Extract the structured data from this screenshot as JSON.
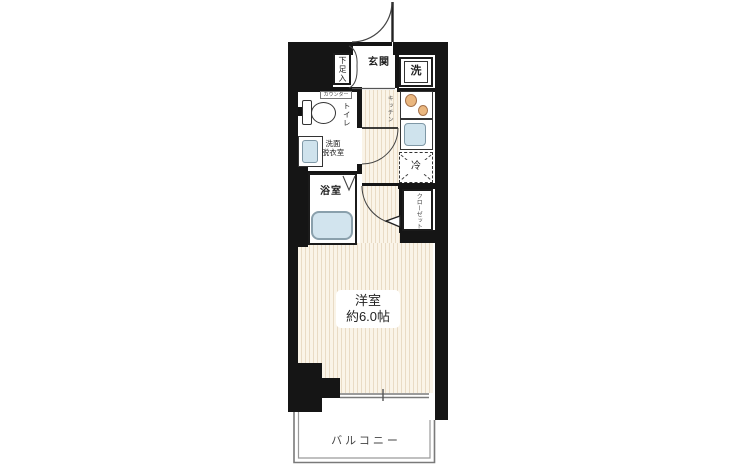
{
  "floor_plan": {
    "type": "apartment-floor-plan",
    "labels": {
      "entrance": "玄関",
      "shoe_storage": "下足入",
      "washing_machine": "洗",
      "counter": "カウンター",
      "toilet": "トイレ",
      "washroom_line1": "洗面",
      "washroom_line2": "脱衣室",
      "bathroom": "浴室",
      "kitchen": "キッチン",
      "refrigerator": "冷",
      "closet": "クローゼット",
      "main_room_name": "洋室",
      "main_room_size": "約6.0帖",
      "balcony": "バルコニー"
    },
    "colors": {
      "wall": "#151515",
      "floor_base": "#faf4e8",
      "floor_stripe": "#e9dbc5",
      "fixture_blue": "#cfe3ed",
      "fixture_blue_border": "#7f98a6",
      "burner_orange": "#eab77f",
      "burner_border": "#a4714a",
      "balcony_line": "#7a7a7a"
    }
  }
}
